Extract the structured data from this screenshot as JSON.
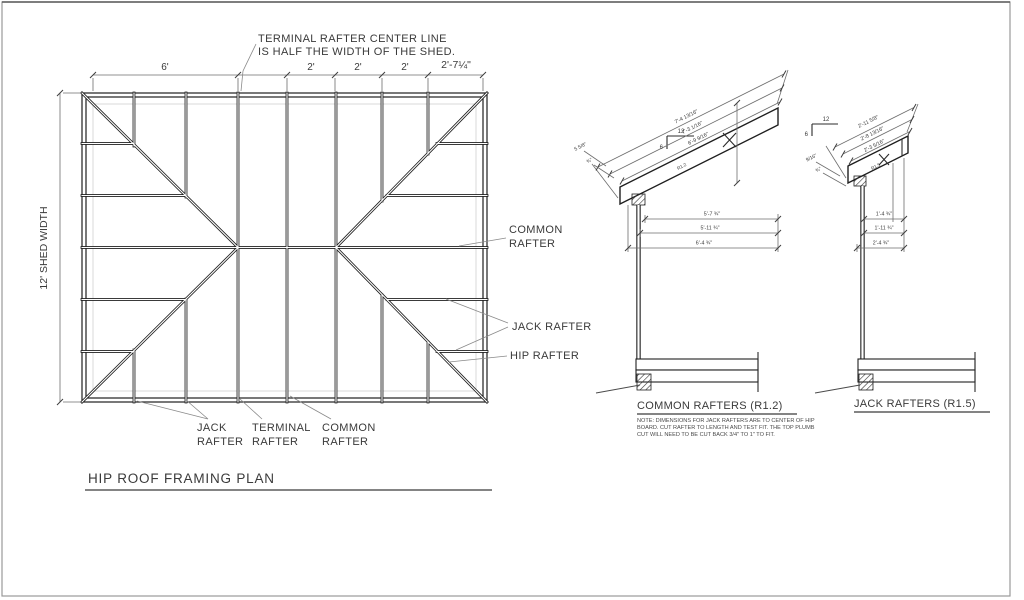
{
  "plan": {
    "callout": {
      "line1": "TERMINAL RAFTER CENTER LINE",
      "line2": "IS HALF THE WIDTH OF THE SHED."
    },
    "top_dims": [
      "6'",
      "2'",
      "2'",
      "2'",
      "2'-7¼\""
    ],
    "left_dim": "12'  SHED WIDTH",
    "labels": {
      "common_r1": "COMMON",
      "common_r2": "RAFTER",
      "jack_r": "JACK RAFTER",
      "hip_r": "HIP RAFTER",
      "jack_b1": "JACK",
      "jack_b2": "RAFTER",
      "terminal_b1": "TERMINAL",
      "terminal_b2": "RAFTER",
      "common_b1": "COMMON",
      "common_b2": "RAFTER"
    },
    "title": "HIP ROOF FRAMING PLAN"
  },
  "common_detail": {
    "title": "COMMON RAFTERS (R1.2)",
    "slope_run": "12",
    "slope_rise": "6",
    "member_tag": "R1.2",
    "slope_dims": [
      "7'-4 13/16\"",
      "7'-3 1/16\"",
      "6'-9 9/16\""
    ],
    "run_dims": [
      "5'-7 ¾\"",
      "5'-11 ¾\"",
      "6'-4 ¾\""
    ],
    "end_dims": [
      "5 5/8\"",
      "¾\""
    ]
  },
  "jack_detail": {
    "title": "JACK RAFTERS (R1.5)",
    "slope_run": "12",
    "slope_rise": "6",
    "member_tag": "R1.5",
    "slope_dims": [
      "2'-11 5/8\"",
      "2'-8 13/16\"",
      "2'-3 5/16\""
    ],
    "run_dims": [
      "1'-4 ¾\"",
      "1'-11 ¾\"",
      "2'-4 ¾\""
    ],
    "end_dims": [
      "9/16\"",
      "¾\""
    ]
  },
  "note": {
    "line1": "NOTE: DIMENSIONS FOR JACK RAFTERS ARE TO CENTER OF HIP",
    "line2": "BOARD. CUT RAFTER TO LENGTH AND TEST FIT. THE TOP PLUMB",
    "line3": "CUT WILL NEED TO BE CUT BACK 3/4\" TO 1\" TO FIT."
  }
}
